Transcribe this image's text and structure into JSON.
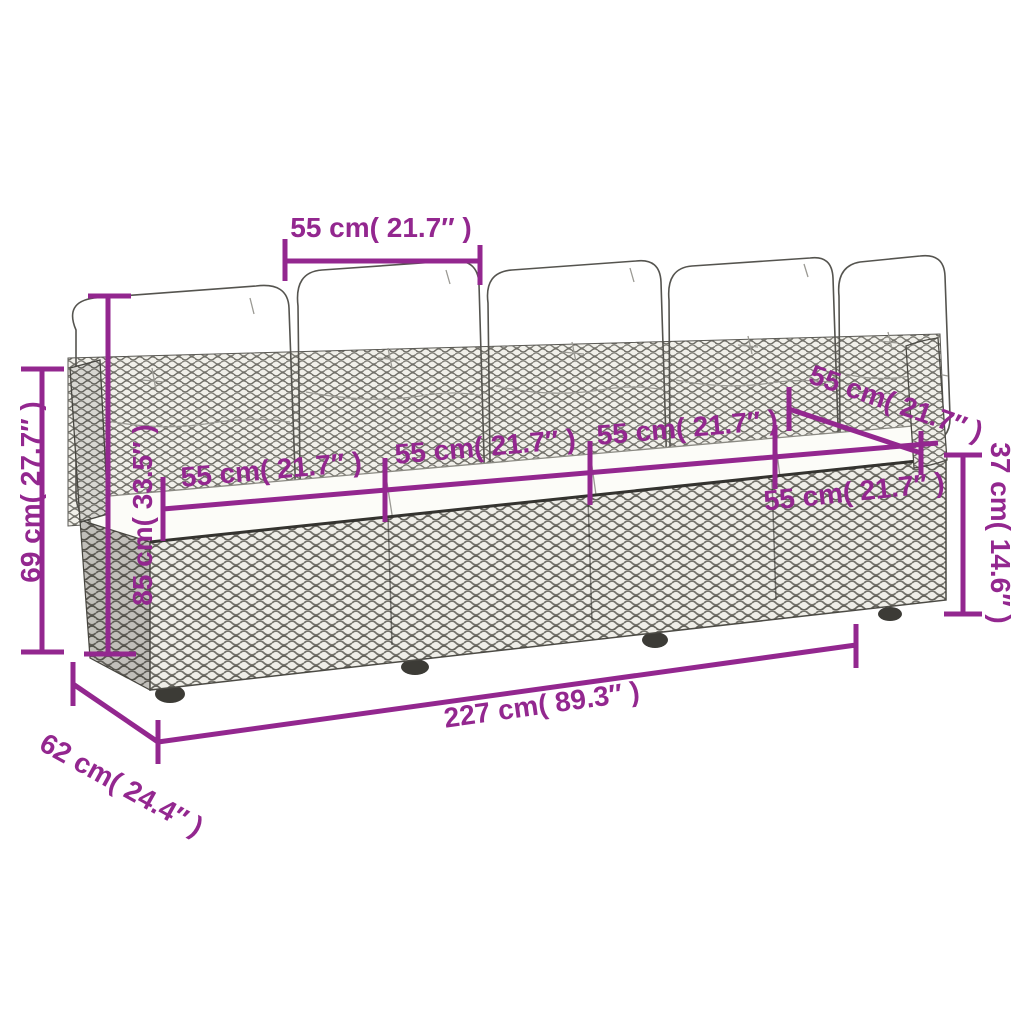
{
  "diagram": {
    "type": "product-dimension-diagram",
    "subject": "4-seat rattan garden sofa with back and seat cushions, perspective line drawing"
  },
  "colors": {
    "dimension_accent": "#93278F",
    "drawing_outline": "#55544f",
    "rattan_fill": "#f1f0ea",
    "background": "#ffffff"
  },
  "dims": {
    "top_back_width": {
      "cm": 55,
      "inch": 21.7,
      "label": "55 cm( 21.7″ )"
    },
    "back_height": {
      "cm": 69,
      "inch": 27.7,
      "label": "69 cm( 27.7″ )"
    },
    "total_height": {
      "cm": 85,
      "inch": 33.5,
      "label": "85 cm( 33.5″ )"
    },
    "seat_1": {
      "cm": 55,
      "inch": 21.7,
      "label": "55 cm( 21.7″ )"
    },
    "seat_2": {
      "cm": 55,
      "inch": 21.7,
      "label": "55 cm( 21.7″ )"
    },
    "seat_3": {
      "cm": 55,
      "inch": 21.7,
      "label": "55 cm( 21.7″ )"
    },
    "seat_4": {
      "cm": 55,
      "inch": 21.7,
      "label": "55 cm( 21.7″ )"
    },
    "right_back_width": {
      "cm": 55,
      "inch": 21.7,
      "label": "55 cm( 21.7″ )"
    },
    "seat_height": {
      "cm": 37,
      "inch": 14.6,
      "label": "37 cm( 14.6″ )"
    },
    "total_width": {
      "cm": 227,
      "inch": 89.3,
      "label": "227 cm( 89.3″ )"
    },
    "depth": {
      "cm": 62,
      "inch": 24.4,
      "label": "62 cm( 24.4″ )"
    }
  }
}
